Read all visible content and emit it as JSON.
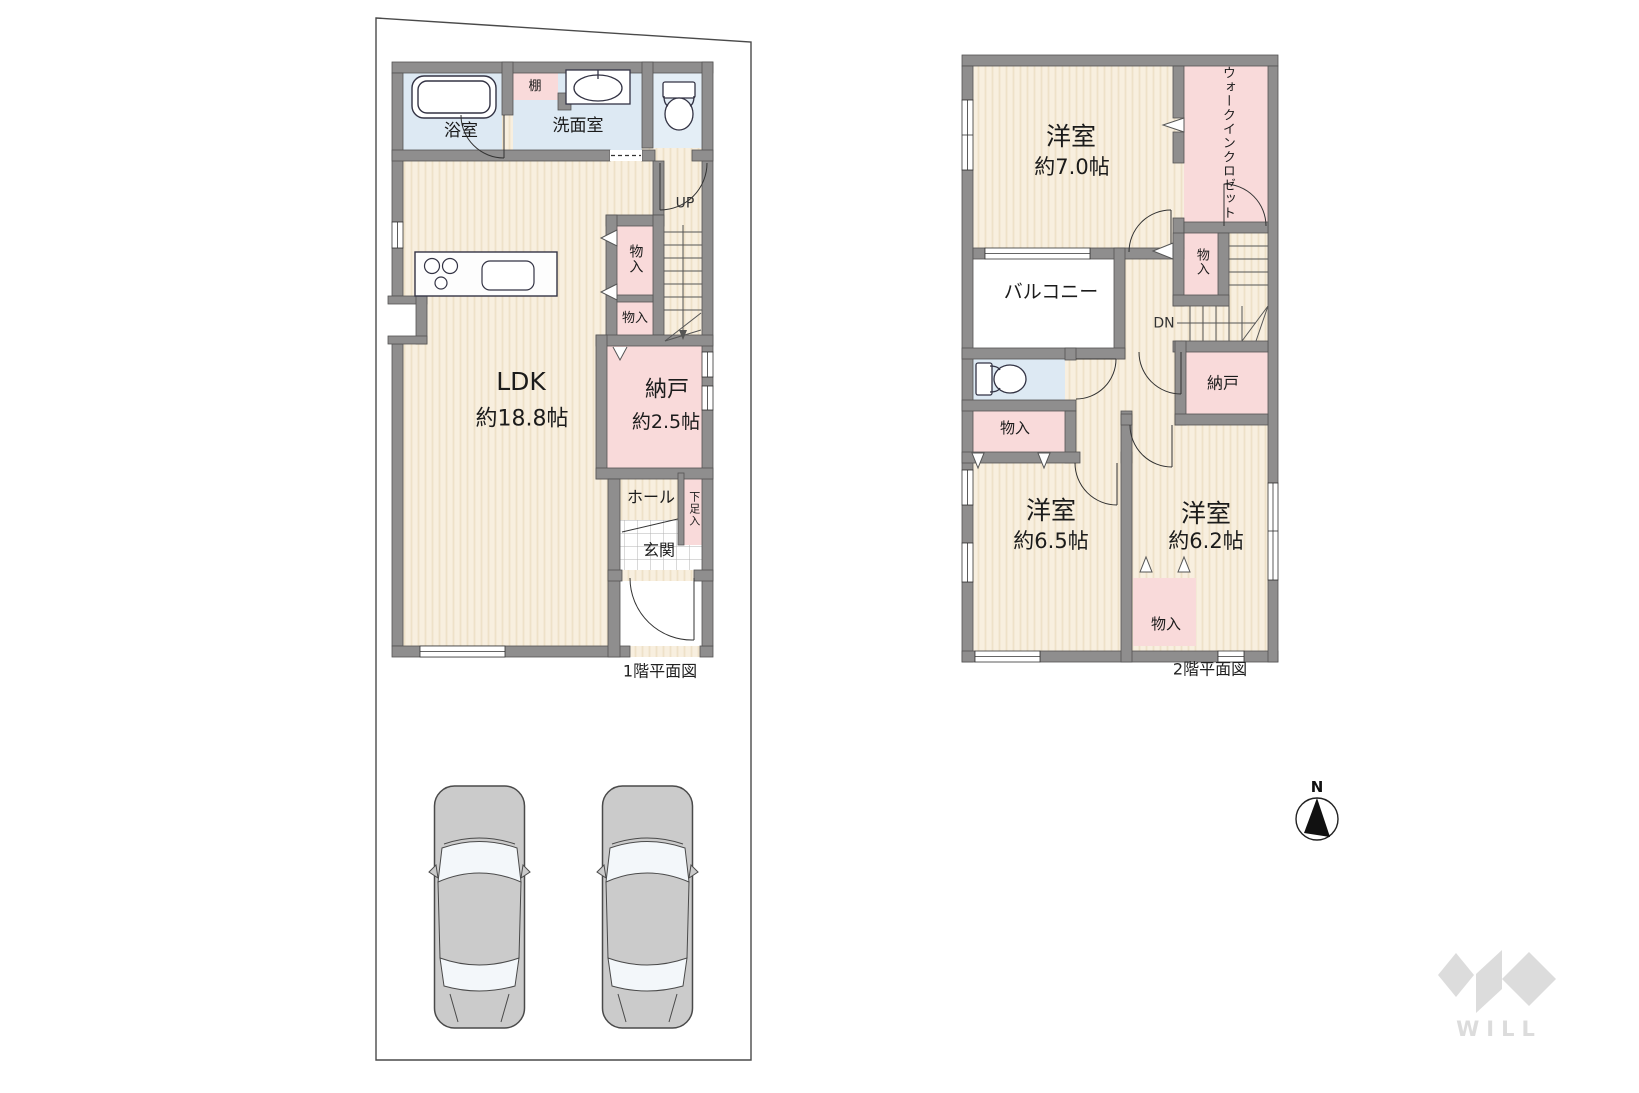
{
  "floor1": {
    "caption": "1階平面図",
    "labels": {
      "bath": "浴室",
      "shelf": "棚",
      "washroom": "洗面室",
      "stairs_up": "UP",
      "closet_a": "物入",
      "closet_b": "物入",
      "ldk_name": "LDK",
      "ldk_area": "約18.8帖",
      "storeroom_name": "納戸",
      "storeroom_area": "約2.5帖",
      "hall": "ホール",
      "shoe_closet": "下足入",
      "entrance": "玄関"
    }
  },
  "floor2": {
    "caption": "2階平面図",
    "labels": {
      "bedroom1_name": "洋室",
      "bedroom1_area": "約7.0帖",
      "wic_line1": "ウォークイン",
      "wic_line2": "クロゼット",
      "balcony": "バルコニー",
      "closet_stairs": "物入",
      "stairs_down": "DN",
      "storeroom": "納戸",
      "closet_left": "物入",
      "bedroom2_name": "洋室",
      "bedroom2_area": "約6.5帖",
      "bedroom3_name": "洋室",
      "bedroom3_area": "約6.2帖",
      "closet_bottom": "物入"
    }
  },
  "compass": {
    "north_label": "N"
  },
  "brand": {
    "logo_text": "WILL"
  },
  "colors": {
    "wall": "#8f8e8e",
    "floor_cream": "#f8efdf",
    "floor_stripe": "#eee1c8",
    "closet_pink": "#f9dada",
    "wet_blue": "#dde9f3",
    "line_dark": "#333333",
    "car_gray": "#cbcbcb",
    "logo_gray": "#dcdcdc"
  }
}
